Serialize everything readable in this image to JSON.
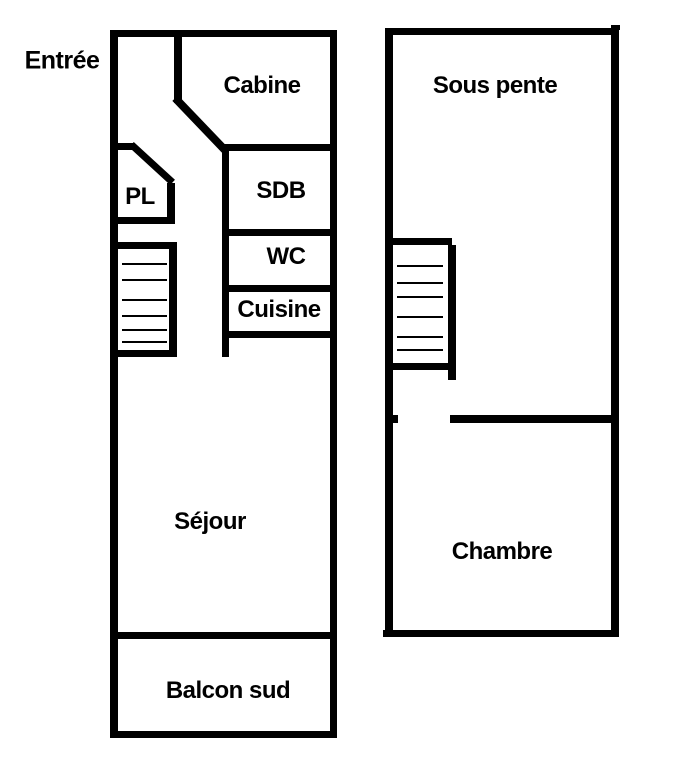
{
  "title": "Apartment floor plan, two levels",
  "colors": {
    "background": "#ffffff",
    "wall": "#000000",
    "text": "#000000"
  },
  "level1": {
    "entry_label": "Entrée",
    "rooms": {
      "cabine": "Cabine",
      "pl": "PL",
      "sdb": "SDB",
      "wc": "WC",
      "cuisine": "Cuisine",
      "sejour": "Séjour",
      "balcon": "Balcon sud"
    }
  },
  "level2": {
    "rooms": {
      "sous_pente": "Sous pente",
      "chambre": "Chambre"
    }
  }
}
